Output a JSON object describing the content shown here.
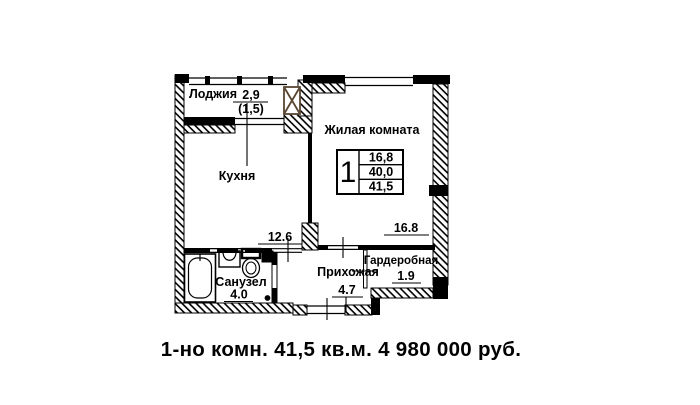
{
  "plan": {
    "loggia_label": "Лоджия",
    "loggia_area": "2,9",
    "loggia_area_reduced": "(1,5)",
    "kitchen_label": "Кухня",
    "kitchen_area": "12.6",
    "living_label": "Жилая комната",
    "living_area": "16.8",
    "bathroom_label": "Санузел",
    "bathroom_area": "4.0",
    "hallway_label": "Прихожая",
    "hallway_area": "4.7",
    "wardrobe_label": "Гардеробная",
    "wardrobe_area": "1.9",
    "stamp": {
      "rooms_count": "1",
      "living_area": "16,8",
      "area_no_balcony": "40,0",
      "total_area": "41,5"
    }
  },
  "caption": {
    "text": "1-но комн. 41,5 кв.м. 4 980 000 руб.",
    "color": "#21397f"
  }
}
